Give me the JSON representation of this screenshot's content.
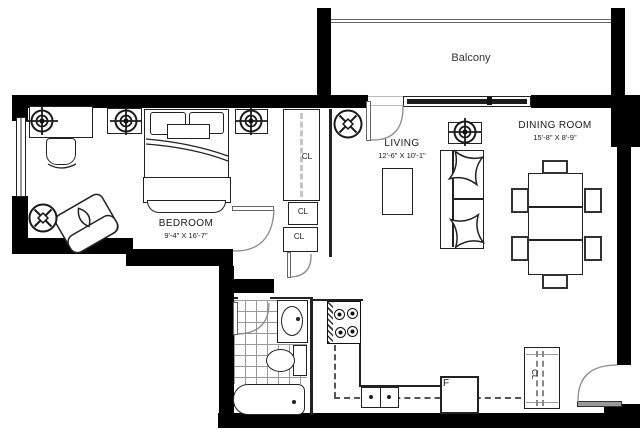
{
  "rooms": {
    "balcony": {
      "label": "Balcony"
    },
    "living": {
      "label": "LIVING",
      "dims": "12'-6\" X 10'-1\""
    },
    "dining": {
      "label": "DINING ROOM",
      "dims": "15'-8\" X 8'-9\""
    },
    "bedroom": {
      "label": "BEDROOM",
      "dims": "9'-4\" X 16'-7\""
    }
  },
  "labels": {
    "closet": "CL",
    "fridge": "F"
  },
  "icons": {
    "ceiling_light": "circle-crosshair",
    "exhaust_fan": "circle-x"
  },
  "colors": {
    "wall": "#000000",
    "line": "#222222",
    "arc": "#8a8a8a",
    "tile_grid": "#9a9a9a"
  }
}
